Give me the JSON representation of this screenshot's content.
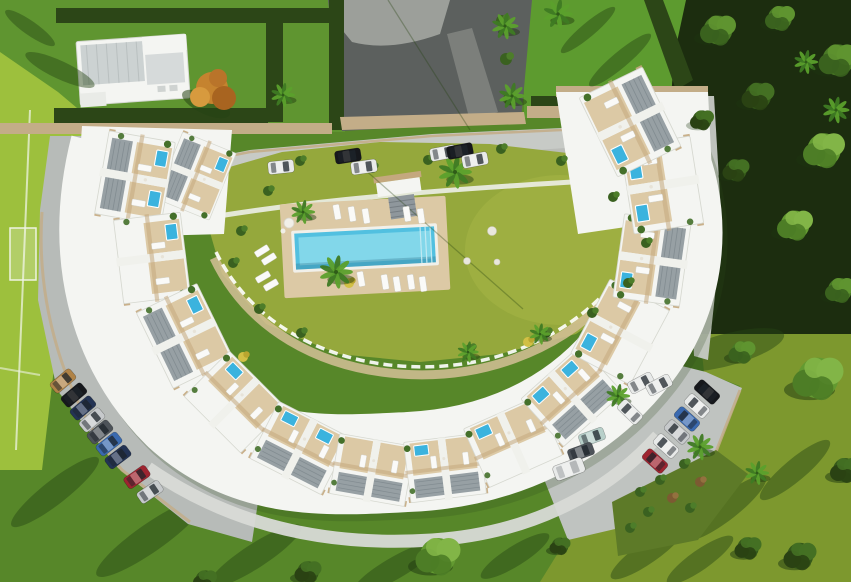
{
  "meta": {
    "type": "aerial-3d-architectural-render",
    "description": "Top-down 3D visualisation of a crescent-shaped apartment complex with rooftop terraces and plunge pools, a central landscaped courtyard with communal swimming pool and sun loungers, surrounded by lawns, a sports field, parking areas with cars, and woodland.",
    "canvas": {
      "width": 851,
      "height": 582
    }
  },
  "palette": {
    "grass_bottom": "#578729",
    "grass_tl": "#5f9530",
    "grass_tr": "#5d9b2f",
    "grass_olive_br": "#7d982e",
    "courtyard_green": "#95a83c",
    "courtyard_sun": "#a8b747",
    "field_green": "#9dc03d",
    "field_line": "#eef3e2",
    "hedge_dark": "#2c4617",
    "shadow_green": "#264415",
    "woods_base": "#1c2d0f",
    "asphalt": "#5c605e",
    "concrete_warm": "#a7aaa5",
    "walk_gray": "#91958f",
    "road_light": "#c7cac6",
    "parking_gray": "#b7bbb8",
    "parking_light": "#bfc3c0",
    "concrete": "#d8dad6",
    "curb_tan": "#c3ad88",
    "building_white": "#f4f5f2",
    "building_shade": "#d9dbd6",
    "terrace_tan": "#dcc9a5",
    "pergola": "#c4a87e",
    "roof_gray": "#8e989d",
    "roof_dark": "#6f7a80",
    "pool_blue": "#52c0e0",
    "pool_light": "#8fdcec",
    "plunge_blue": "#3bb3de",
    "lounger_white": "#fafaf8",
    "orange_tree": "#c5832f",
    "orange_dark": "#a86420",
    "palm_green": "#3e7a23",
    "palm_light": "#5ba02c",
    "garden_brown": "#7c5a32",
    "car_white": "#e8eae9",
    "car_black": "#16181c",
    "car_silver": "#c6c9cb",
    "car_red": "#9e2430",
    "car_blue": "#3a6ab0",
    "car_navy": "#233354",
    "car_gray": "#4d5359",
    "car_tan": "#b08347",
    "car_teal": "#b7cfc9"
  },
  "scene": {
    "units": [
      {
        "x": 196,
        "y": 176,
        "rot": 112,
        "s": 0.9,
        "g": 1,
        "p": 1
      },
      {
        "x": 135,
        "y": 178,
        "rot": 100,
        "s": 1.05,
        "g": 1,
        "p": 2
      },
      {
        "x": 152,
        "y": 258,
        "rot": 83,
        "s": 1.05,
        "g": 0,
        "p": 1
      },
      {
        "x": 185,
        "y": 336,
        "rot": 64,
        "s": 1.05,
        "g": 1,
        "p": 1
      },
      {
        "x": 235,
        "y": 402,
        "rot": 45,
        "s": 1,
        "g": 0,
        "p": 1
      },
      {
        "x": 300,
        "y": 448,
        "rot": 27,
        "s": 1,
        "g": 1,
        "p": 2
      },
      {
        "x": 372,
        "y": 470,
        "rot": 10,
        "s": 0.95,
        "g": 1,
        "p": 0
      },
      {
        "x": 445,
        "y": 468,
        "rot": -7,
        "s": 0.95,
        "g": 1,
        "p": 1
      },
      {
        "x": 513,
        "y": 442,
        "rot": -24,
        "s": 1,
        "g": 0,
        "p": 1
      },
      {
        "x": 572,
        "y": 396,
        "rot": -42,
        "s": 1,
        "g": 1,
        "p": 2
      },
      {
        "x": 620,
        "y": 332,
        "rot": -62,
        "s": 1.05,
        "g": 0,
        "p": 1
      },
      {
        "x": 652,
        "y": 260,
        "rot": -82,
        "s": 1.05,
        "g": 1,
        "p": 1
      },
      {
        "x": 662,
        "y": 185,
        "rot": -99,
        "s": 1.1,
        "g": 0,
        "p": 2
      },
      {
        "x": 630,
        "y": 122,
        "rot": -116,
        "s": 1.1,
        "g": 1,
        "p": 1
      }
    ],
    "cars": {
      "upper_road": [
        {
          "x": 281,
          "y": 167,
          "r": 84,
          "c": "car_white"
        },
        {
          "x": 348,
          "y": 156,
          "r": 81,
          "c": "car_black"
        },
        {
          "x": 364,
          "y": 167,
          "r": 82,
          "c": "car_white"
        },
        {
          "x": 443,
          "y": 153,
          "r": 79,
          "c": "car_white"
        },
        {
          "x": 460,
          "y": 151,
          "r": 79,
          "c": "car_black"
        },
        {
          "x": 475,
          "y": 160,
          "r": 79,
          "c": "car_white"
        }
      ],
      "lower_left": [
        {
          "x": 63,
          "y": 381,
          "r": 50,
          "c": "car_tan"
        },
        {
          "x": 74,
          "y": 395,
          "r": 50,
          "c": "car_black"
        },
        {
          "x": 83,
          "y": 408,
          "r": 50,
          "c": "car_navy"
        },
        {
          "x": 92,
          "y": 420,
          "r": 50,
          "c": "car_silver"
        },
        {
          "x": 100,
          "y": 432,
          "r": 51,
          "c": "car_gray"
        },
        {
          "x": 109,
          "y": 444,
          "r": 52,
          "c": "car_blue"
        },
        {
          "x": 118,
          "y": 457,
          "r": 53,
          "c": "car_navy"
        },
        {
          "x": 137,
          "y": 477,
          "r": 55,
          "c": "car_red"
        },
        {
          "x": 150,
          "y": 492,
          "r": 56,
          "c": "car_silver"
        }
      ],
      "lower_right": [
        {
          "x": 707,
          "y": 392,
          "r": -48,
          "c": "car_black"
        },
        {
          "x": 697,
          "y": 406,
          "r": -48,
          "c": "car_white"
        },
        {
          "x": 687,
          "y": 419,
          "r": -48,
          "c": "car_blue"
        },
        {
          "x": 677,
          "y": 432,
          "r": -48,
          "c": "car_silver"
        },
        {
          "x": 666,
          "y": 446,
          "r": -48,
          "c": "car_white"
        },
        {
          "x": 655,
          "y": 461,
          "r": -48,
          "c": "car_red"
        },
        {
          "x": 630,
          "y": 412,
          "r": -46,
          "c": "car_white"
        },
        {
          "x": 592,
          "y": 437,
          "r": 70,
          "c": "car_teal"
        },
        {
          "x": 581,
          "y": 452,
          "r": 70,
          "c": "car_gray"
        },
        {
          "x": 569,
          "y": 469,
          "r": 70,
          "c": "car_white",
          "van": 1
        },
        {
          "x": 641,
          "y": 383,
          "r": 62,
          "c": "car_white"
        },
        {
          "x": 659,
          "y": 385,
          "r": 62,
          "c": "car_white"
        }
      ]
    },
    "palms": [
      {
        "x": 505,
        "y": 26,
        "s": 1
      },
      {
        "x": 512,
        "y": 96,
        "s": 1
      },
      {
        "x": 558,
        "y": 14,
        "s": 1.1
      },
      {
        "x": 455,
        "y": 172,
        "s": 1.25
      },
      {
        "x": 336,
        "y": 272,
        "s": 1.25
      },
      {
        "x": 303,
        "y": 212,
        "s": 0.9
      },
      {
        "x": 468,
        "y": 352,
        "s": 0.8
      },
      {
        "x": 540,
        "y": 334,
        "s": 0.8
      },
      {
        "x": 618,
        "y": 396,
        "s": 0.9
      },
      {
        "x": 700,
        "y": 447,
        "s": 1
      },
      {
        "x": 757,
        "y": 473,
        "s": 0.9
      },
      {
        "x": 283,
        "y": 95,
        "s": 0.9
      },
      {
        "x": 836,
        "y": 110,
        "s": 1
      },
      {
        "x": 806,
        "y": 62,
        "s": 0.9
      }
    ],
    "round_trees": [
      {
        "x": 438,
        "y": 556,
        "s": 1.5,
        "t": "light"
      },
      {
        "x": 308,
        "y": 572,
        "s": 0.9,
        "t": "dark"
      },
      {
        "x": 205,
        "y": 580,
        "s": 0.8,
        "t": "dark"
      },
      {
        "x": 560,
        "y": 546,
        "s": 0.7,
        "t": "dark"
      },
      {
        "x": 818,
        "y": 378,
        "s": 1.7,
        "t": "light"
      },
      {
        "x": 742,
        "y": 352,
        "s": 0.9,
        "t": "mid"
      },
      {
        "x": 800,
        "y": 556,
        "s": 1.1,
        "t": "dark"
      },
      {
        "x": 748,
        "y": 548,
        "s": 0.9,
        "t": "dark"
      },
      {
        "x": 845,
        "y": 470,
        "s": 1,
        "t": "dark"
      }
    ],
    "woods_trees": [
      {
        "x": 718,
        "y": 30,
        "s": 1.2,
        "t": "mid"
      },
      {
        "x": 780,
        "y": 18,
        "s": 1,
        "t": "mid"
      },
      {
        "x": 838,
        "y": 60,
        "s": 1.3,
        "t": "mid"
      },
      {
        "x": 758,
        "y": 96,
        "s": 1.1,
        "t": "dark"
      },
      {
        "x": 824,
        "y": 150,
        "s": 1.4,
        "t": "light"
      },
      {
        "x": 736,
        "y": 170,
        "s": 0.9,
        "t": "dark"
      },
      {
        "x": 795,
        "y": 225,
        "s": 1.2,
        "t": "light"
      },
      {
        "x": 840,
        "y": 290,
        "s": 1,
        "t": "mid"
      },
      {
        "x": 702,
        "y": 120,
        "s": 0.8,
        "t": "dark"
      }
    ],
    "shadows": [
      {
        "x": 55,
        "y": 492,
        "rx": 55,
        "ry": 12,
        "rot": -38
      },
      {
        "x": 150,
        "y": 538,
        "rx": 65,
        "ry": 14,
        "rot": -35
      },
      {
        "x": 255,
        "y": 556,
        "rx": 55,
        "ry": 12,
        "rot": -33
      },
      {
        "x": 395,
        "y": 568,
        "rx": 48,
        "ry": 11,
        "rot": -30
      },
      {
        "x": 515,
        "y": 556,
        "rx": 40,
        "ry": 10,
        "rot": -32
      },
      {
        "x": 648,
        "y": 552,
        "rx": 45,
        "ry": 11,
        "rot": -35
      },
      {
        "x": 726,
        "y": 508,
        "rx": 50,
        "ry": 12,
        "rot": -38
      },
      {
        "x": 795,
        "y": 470,
        "rx": 45,
        "ry": 11,
        "rot": -40
      },
      {
        "x": 700,
        "y": 560,
        "rx": 40,
        "ry": 10,
        "rot": -35
      },
      {
        "x": 726,
        "y": 350,
        "rx": 60,
        "ry": 16,
        "rot": -15
      },
      {
        "x": 30,
        "y": 28,
        "rx": 30,
        "ry": 7,
        "rot": 35
      },
      {
        "x": 60,
        "y": 70,
        "rx": 38,
        "ry": 9,
        "rot": 25
      },
      {
        "x": 620,
        "y": 60,
        "rx": 40,
        "ry": 8,
        "rot": -40
      },
      {
        "x": 588,
        "y": 30,
        "rx": 35,
        "ry": 7,
        "rot": -40
      }
    ],
    "bushes": [
      {
        "x": 300,
        "y": 161
      },
      {
        "x": 268,
        "y": 191
      },
      {
        "x": 241,
        "y": 231
      },
      {
        "x": 233,
        "y": 263
      },
      {
        "x": 259,
        "y": 309
      },
      {
        "x": 301,
        "y": 333
      },
      {
        "x": 470,
        "y": 349
      },
      {
        "x": 546,
        "y": 333
      },
      {
        "x": 592,
        "y": 313
      },
      {
        "x": 628,
        "y": 283
      },
      {
        "x": 646,
        "y": 243
      },
      {
        "x": 613,
        "y": 197
      },
      {
        "x": 561,
        "y": 161
      },
      {
        "x": 501,
        "y": 149
      },
      {
        "x": 372,
        "y": 168
      },
      {
        "x": 428,
        "y": 160
      },
      {
        "x": 502,
        "y": 21,
        "s": 1.2
      },
      {
        "x": 506,
        "y": 59,
        "s": 1.2
      },
      {
        "x": 509,
        "y": 99,
        "s": 1.2
      },
      {
        "x": 349,
        "y": 283,
        "t": "y"
      },
      {
        "x": 243,
        "y": 357,
        "t": "y"
      },
      {
        "x": 528,
        "y": 342,
        "t": "y"
      },
      {
        "x": 640,
        "y": 492
      },
      {
        "x": 660,
        "y": 480
      },
      {
        "x": 684,
        "y": 464
      },
      {
        "x": 648,
        "y": 512
      },
      {
        "x": 690,
        "y": 508
      },
      {
        "x": 672,
        "y": 498,
        "t": "b"
      },
      {
        "x": 700,
        "y": 482,
        "t": "b"
      },
      {
        "x": 630,
        "y": 528
      }
    ],
    "pebbles": [
      {
        "x": 492,
        "y": 231,
        "r": 4.5
      },
      {
        "x": 467,
        "y": 261,
        "r": 3.5
      },
      {
        "x": 497,
        "y": 262,
        "r": 3
      }
    ],
    "loungers": [
      {
        "x": 337,
        "y": 212,
        "r": -10
      },
      {
        "x": 352,
        "y": 214,
        "r": -9
      },
      {
        "x": 366,
        "y": 216,
        "r": -9
      },
      {
        "x": 407,
        "y": 214,
        "r": -9
      },
      {
        "x": 421,
        "y": 216,
        "r": -8
      },
      {
        "x": 361,
        "y": 279,
        "r": -10
      },
      {
        "x": 385,
        "y": 282,
        "r": -9
      },
      {
        "x": 397,
        "y": 284,
        "r": -9
      },
      {
        "x": 411,
        "y": 282,
        "r": -8
      },
      {
        "x": 423,
        "y": 284,
        "r": -8
      },
      {
        "x": 262,
        "y": 251,
        "r": 58
      },
      {
        "x": 269,
        "y": 259,
        "r": 58
      },
      {
        "x": 263,
        "y": 277,
        "r": 60
      },
      {
        "x": 271,
        "y": 285,
        "r": 60
      }
    ]
  }
}
